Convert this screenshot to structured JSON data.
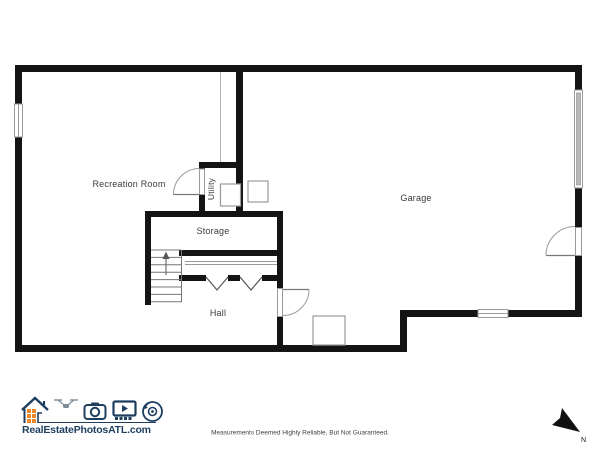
{
  "plan": {
    "rooms": {
      "recreation": "Recreation Room",
      "utility": "Utility",
      "storage": "Storage",
      "hall": "Hall",
      "garage": "Garage"
    }
  },
  "footer": {
    "brand": "RealEstatePhotosATL.com",
    "disclaimer": "Measurements Deemed Highly Reliable, But Not Guaranteed.",
    "compass_label": "N"
  },
  "colors": {
    "wall": "#141414",
    "thin_detail": "#9a9a9a",
    "garage_door": "#b8b8b8",
    "logo_navy": "#1d3e5f",
    "logo_orange": "#e8882b"
  },
  "icons": {
    "logo_icons": [
      "house-icon",
      "drone-icon",
      "camera-icon",
      "video-tour-icon",
      "camera-360-icon"
    ],
    "compass": "north-arrow-icon"
  }
}
